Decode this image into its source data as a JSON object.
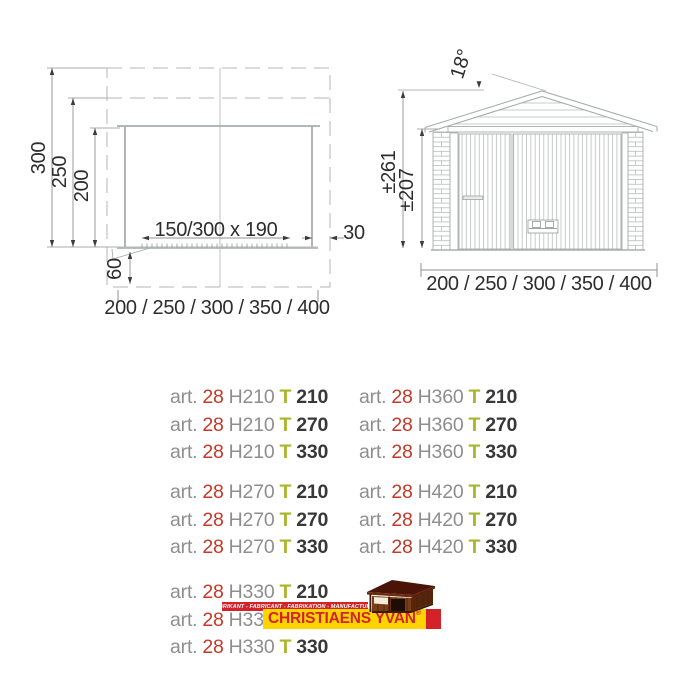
{
  "plan": {
    "depth_300": "300",
    "depth_250": "250",
    "depth_200": "200",
    "door_label": "150/300 x 190",
    "overhang_label": "30",
    "door_offset_label": "60",
    "width_label": "200 / 250 / 300 / 350 / 400"
  },
  "elevation": {
    "roof_angle_label": "18°",
    "ridge_height_label": "±261",
    "wall_height_label": "±207",
    "width_label": "200 / 250 / 300 / 350 / 400"
  },
  "articles": {
    "prefix": "art.",
    "series": "28",
    "left": [
      {
        "h": "H210",
        "t": "T",
        "size": "210"
      },
      {
        "h": "H210",
        "t": "T",
        "size": "270"
      },
      {
        "h": "H210",
        "t": "T",
        "size": "330"
      },
      {
        "h": "H270",
        "t": "T",
        "size": "210"
      },
      {
        "h": "H270",
        "t": "T",
        "size": "270"
      },
      {
        "h": "H270",
        "t": "T",
        "size": "330"
      },
      {
        "h": "H330",
        "t": "T",
        "size": "210"
      },
      {
        "h": "H33"
      },
      {
        "h": "H330",
        "t": "T",
        "size": "330"
      }
    ],
    "right": [
      {
        "h": "H360",
        "t": "T",
        "size": "210"
      },
      {
        "h": "H360",
        "t": "T",
        "size": "270"
      },
      {
        "h": "H360",
        "t": "T",
        "size": "330"
      },
      {
        "h": "H420",
        "t": "T",
        "size": "210"
      },
      {
        "h": "H420",
        "t": "T",
        "size": "270"
      },
      {
        "h": "H420",
        "t": "T",
        "size": "330"
      }
    ]
  },
  "logo": {
    "tagline": "FABRIKANT - FABRICANT - FABRIKATION - MANUFACTURER",
    "brand": "CHRISTIAENS YVAN",
    "registered": "®"
  },
  "colors": {
    "drawing_line": "#a9adad",
    "dimension_text": "#2d2d2d",
    "article_gray": "#8e8e8e",
    "article_red": "#c4392a",
    "article_green": "#a9b62c",
    "article_dark": "#383838",
    "logo_red": "#d2232a",
    "logo_yellow": "#ffd400"
  }
}
